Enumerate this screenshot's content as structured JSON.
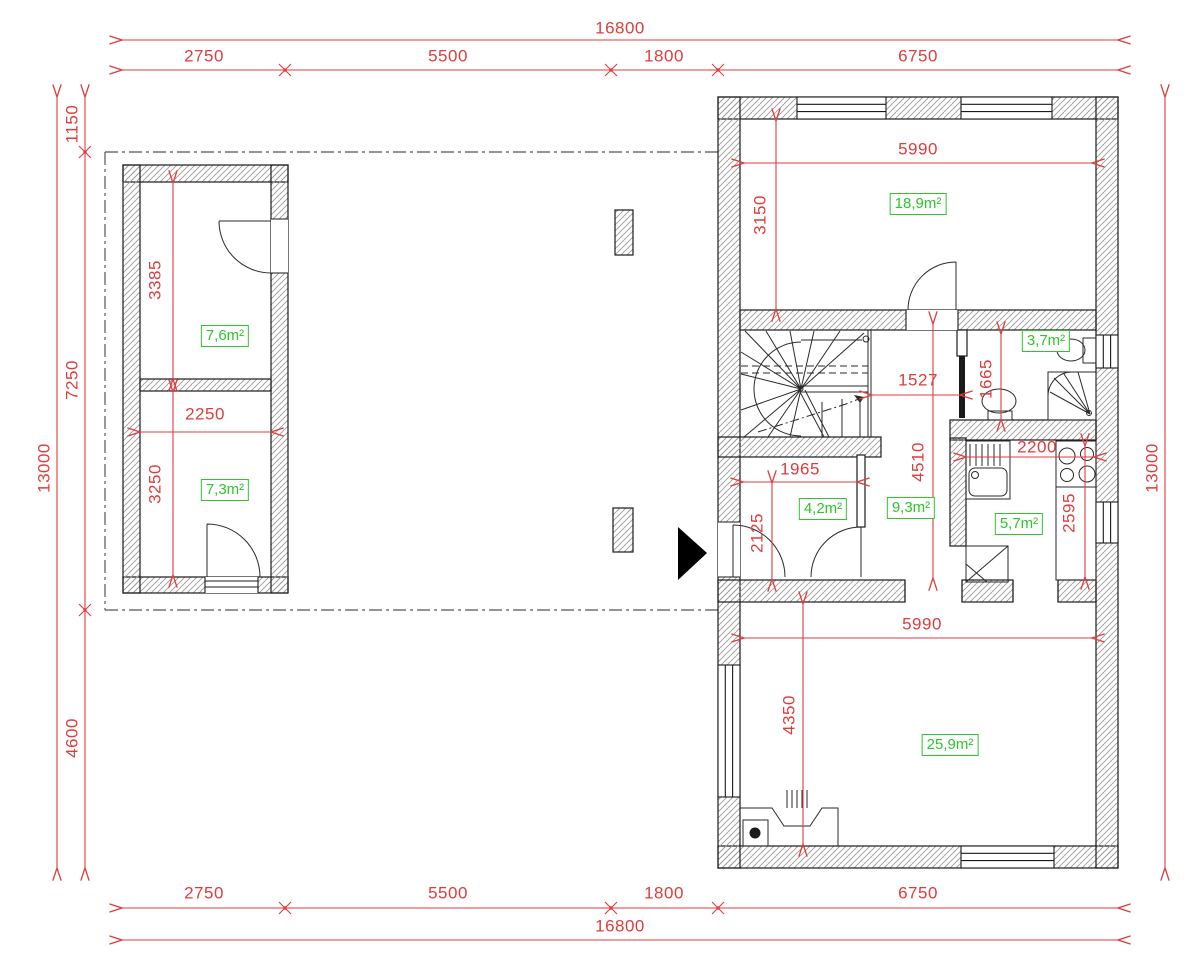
{
  "title": "house-ground-floor-plan",
  "colors": {
    "dimension": "#de3d3d",
    "area_label": "#2ec42e",
    "wall": "#1a1a1a",
    "hatch": "#9b9b9b"
  },
  "dimension_chains": {
    "top": {
      "overall": "16800",
      "segments": [
        "2750",
        "5500",
        "1800",
        "6750"
      ]
    },
    "bottom": {
      "overall": "16800",
      "segments": [
        "2750",
        "5500",
        "1800",
        "6750"
      ]
    },
    "left": {
      "overall": "13000",
      "segments": [
        "1150",
        "7250",
        "4600"
      ]
    },
    "right": {
      "overall": "13000"
    }
  },
  "outbuilding": {
    "top_room": {
      "area": "7,6m²",
      "depth": "3385"
    },
    "bottom_room": {
      "area": "7,3m²",
      "width": "2250",
      "depth": "3250"
    }
  },
  "house": {
    "bedroom": {
      "area": "18,9m²",
      "width": "5990",
      "depth": "3150"
    },
    "hall": {
      "area": "9,3m²",
      "width": "1527",
      "depth": "4510"
    },
    "bathroom": {
      "area": "3,7m²",
      "depth": "1665"
    },
    "kitchen": {
      "area": "5,7m²",
      "width": "2200",
      "depth": "2595"
    },
    "entry": {
      "area": "4,2m²",
      "width": "1965",
      "depth": "2125"
    },
    "living_room": {
      "area": "25,9m²",
      "width": "5990",
      "depth": "4350"
    }
  },
  "icons": {
    "entrance_marker": "entrance-arrow"
  }
}
